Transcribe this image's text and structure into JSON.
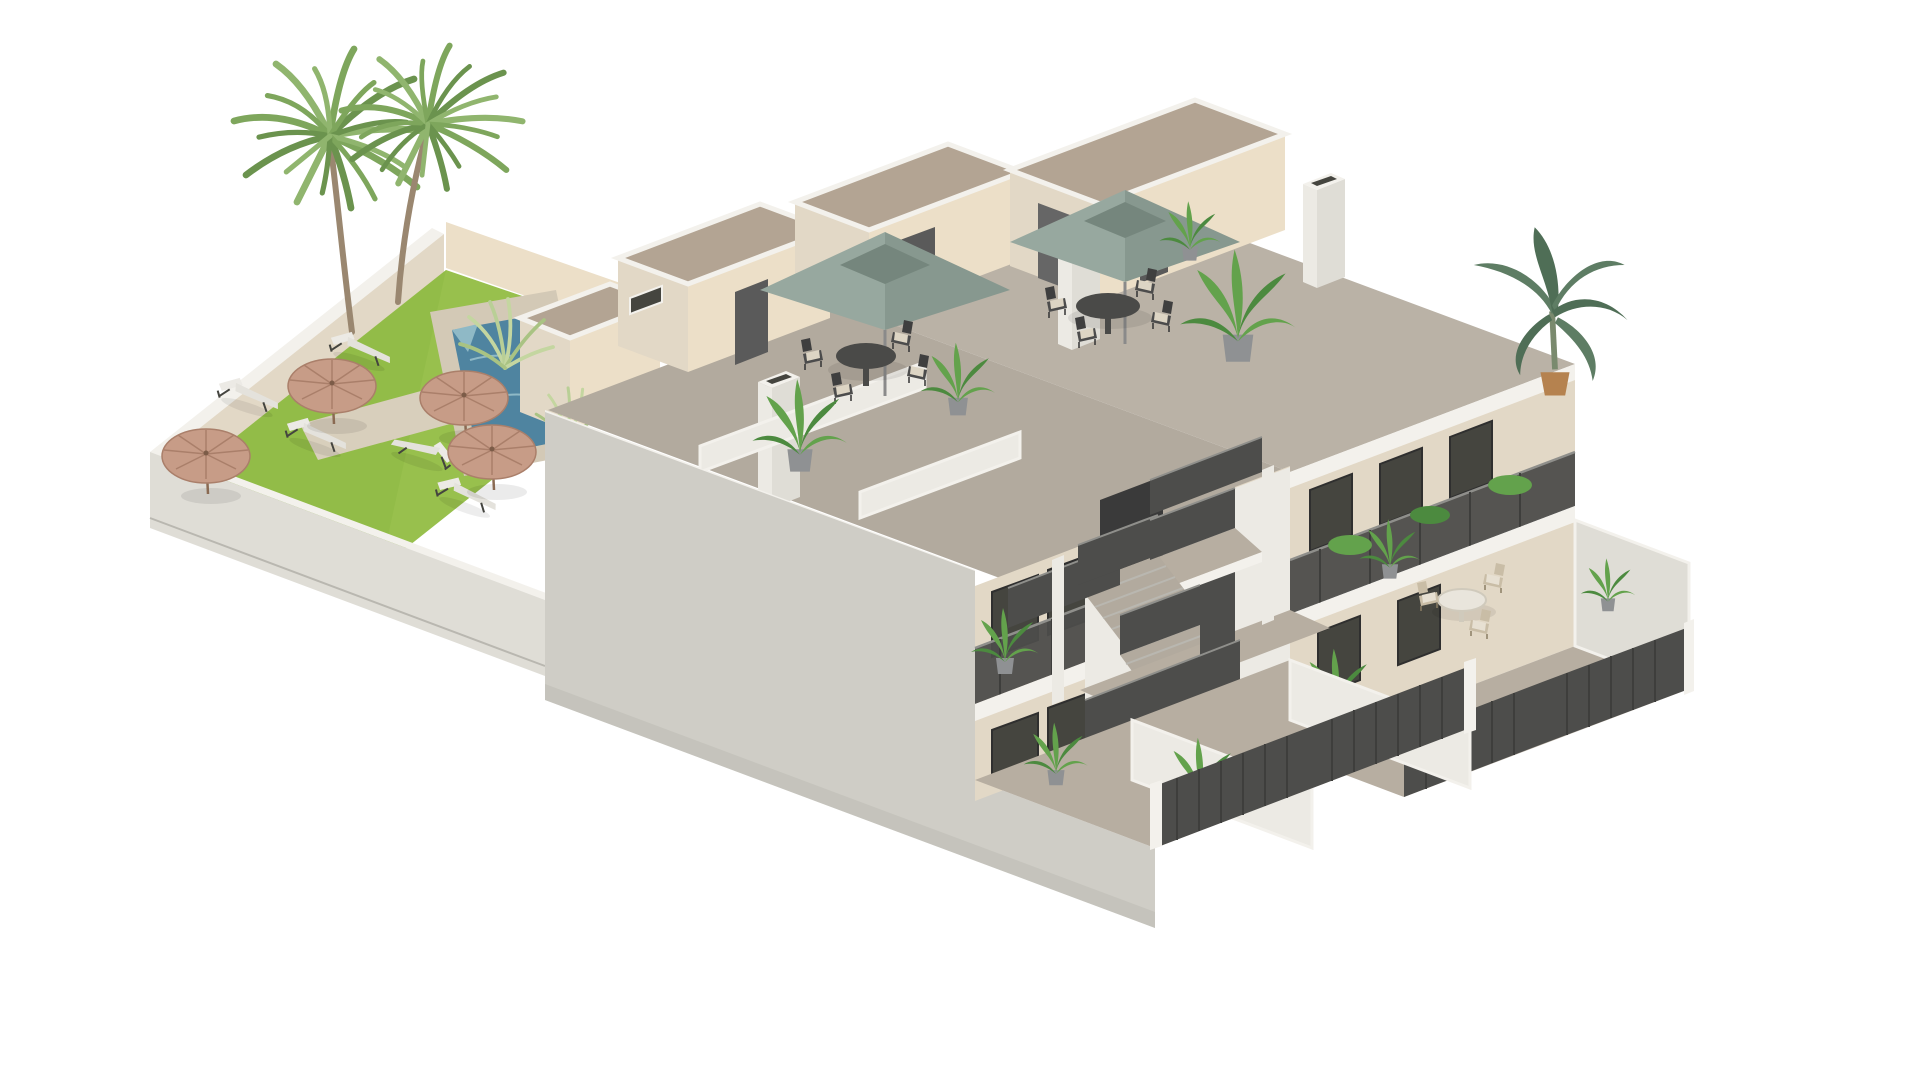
{
  "scene": {
    "description": "Isometric 3D architectural render of a two-storey apartment residence on a white background: walled communal garden with lawn, swimming pool, two palm trees, straw parasols and sun loungers on the left; building with large plain side wall, roof terraces with stair bulkheads, chimneys, two square sage-green patio umbrellas with outdoor dining sets, potted plants, an external switchback staircase with dark perforated metal railings, first-floor balconies, ground-floor private courtyards with dark slat fences, and a right wing with terraces, round table set and a banana plant on the roof corner.",
    "background": "#ffffff"
  },
  "colors": {
    "bg": "#ffffff",
    "coping": "#f3f1ec",
    "wallWhite": "#eceae4",
    "wallLight": "#dfddd6",
    "wallGray": "#cfcdc6",
    "wallShade": "#b9b7b0",
    "cream": "#e2d8c6",
    "creamLit": "#ecdfc8",
    "gravel": "#b3a493",
    "deck1": "#b2aa9e",
    "deck2": "#bab2a6",
    "deckWarm": "#b7aea1",
    "stone": "#d3c9b6",
    "path": "#d8cfbc",
    "lawn": "#98c04d",
    "lawnDark": "#86b23c",
    "pool": "#4f84a0",
    "poolLight": "#8fb9c6",
    "straw": "#c79c87",
    "strawDark": "#aa7f6a",
    "umbrella": "#87988f",
    "umbrellaLit": "#97a89f",
    "umbrellaDark": "#75867d",
    "door": "#5a5a5a",
    "glass": "#45453f",
    "rail": "#4d4d4b",
    "railLight": "#8f8f8b",
    "plant": "#63a24c",
    "plantDark": "#4c8a3f",
    "plantPale": "#c4d6a0",
    "pot": "#8f9193",
    "potClay": "#b5824f",
    "trunk": "#9a8770",
    "furnDark": "#4a4a48",
    "cushion": "#ddd5c4",
    "tableWhite": "#e9e5dc",
    "wicker": "#c9bda6",
    "banana": "#5e7d64",
    "bananaDark": "#4f6e56"
  },
  "garden": {
    "label": "communal walled garden",
    "palm_trees": 2,
    "sun_loungers": 5,
    "straw_parasols": 4,
    "swimming_pool": 1,
    "stone_path": true
  },
  "building": {
    "label": "two-storey apartment building",
    "storeys": 2,
    "roof_terraces": 3,
    "stair_bulkheads": 3,
    "chimneys": 3,
    "roof_umbrellas": 2,
    "roof_dining_sets": 2,
    "external_staircases": 1,
    "balcony_railings": "dark perforated metal",
    "ground_courtyards": 4,
    "courtyard_fences": 4,
    "potted_plants": 12,
    "banana_plants": 1
  }
}
